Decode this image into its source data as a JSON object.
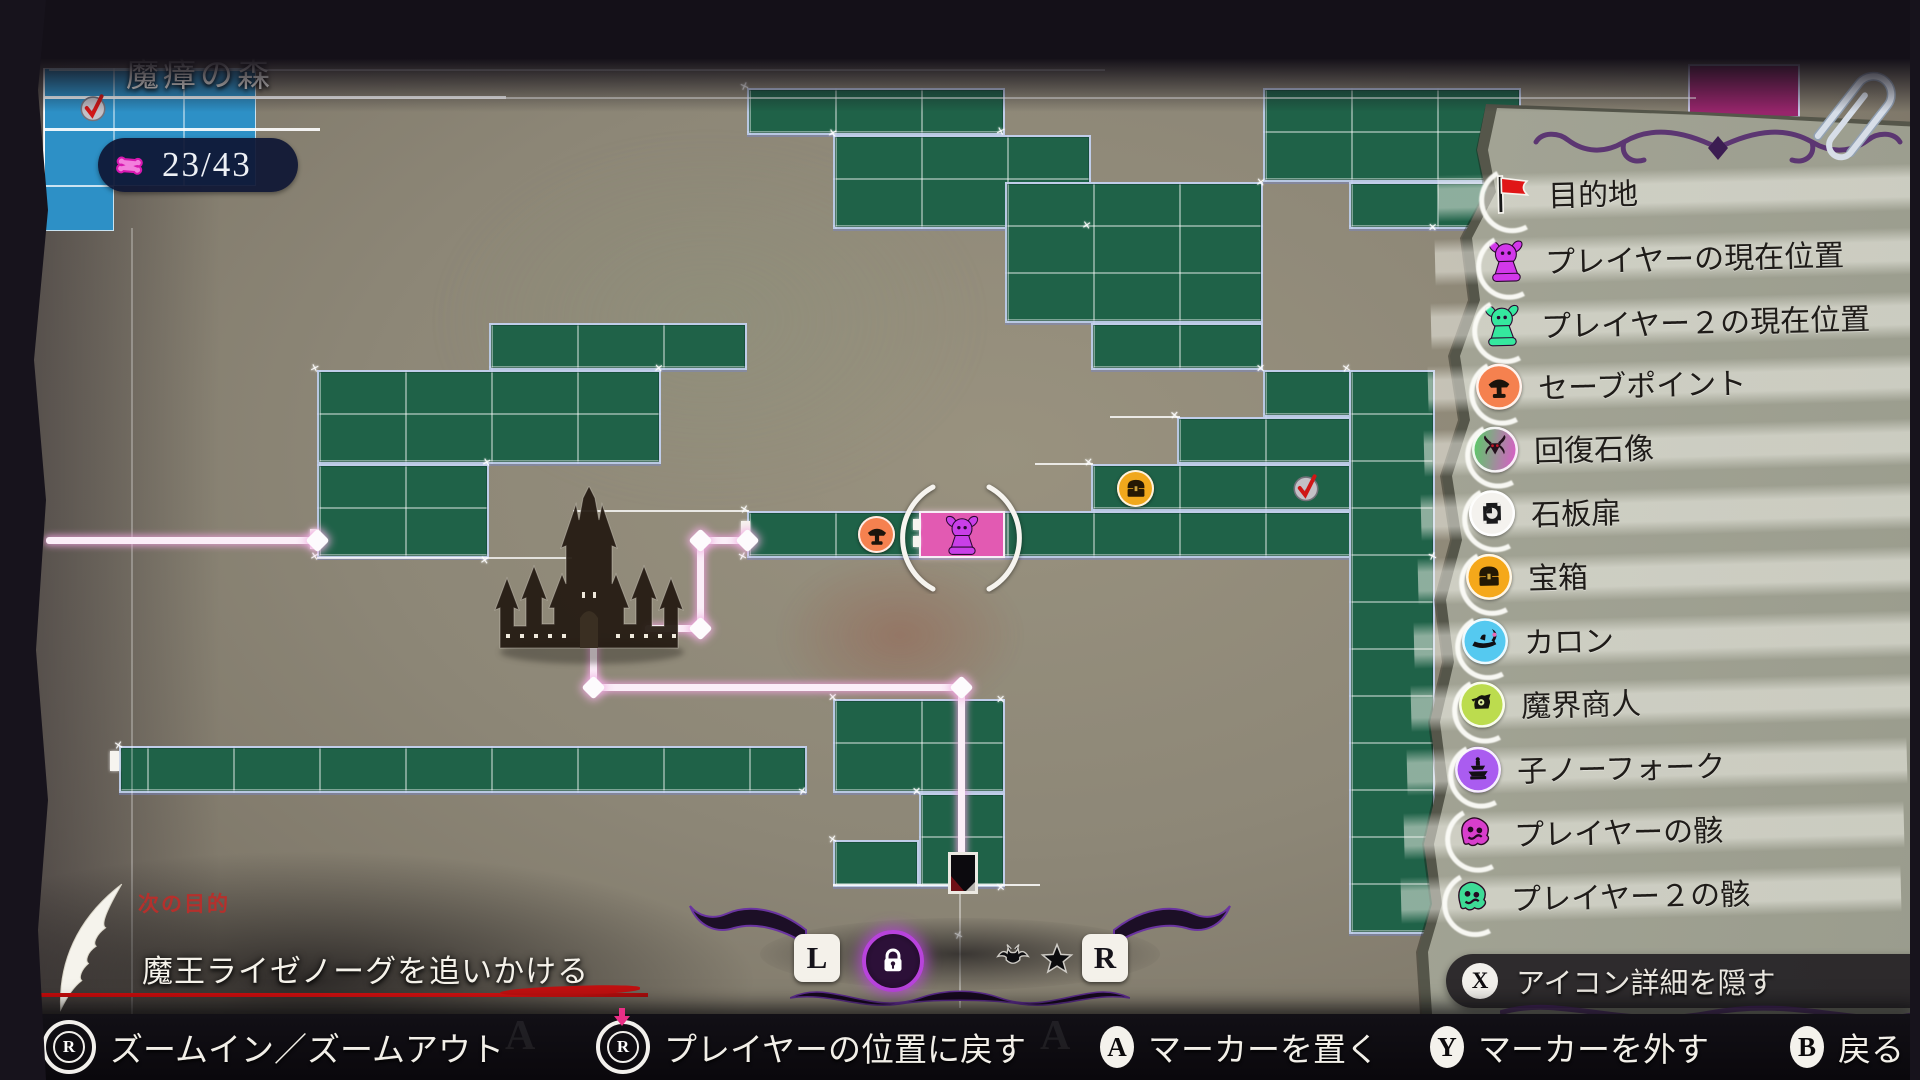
{
  "map": {
    "title": "魔瘴の森",
    "counter": "23/43",
    "grid": {
      "ox": 59,
      "oy": 88,
      "cw": 86,
      "ch": 47
    },
    "green_cells": [
      [
        8,
        0,
        3,
        1
      ],
      [
        9,
        1,
        3,
        2
      ],
      [
        11,
        2,
        3,
        3
      ],
      [
        12,
        5,
        2,
        1
      ],
      [
        14,
        0,
        3,
        2
      ],
      [
        15,
        2,
        2,
        1
      ],
      [
        14,
        6,
        2,
        1
      ],
      [
        13,
        7,
        3,
        1
      ],
      [
        12,
        8,
        4,
        1
      ],
      [
        8,
        9,
        8,
        1
      ],
      [
        15,
        6,
        1,
        12
      ],
      [
        5,
        5,
        3,
        1
      ],
      [
        3,
        6,
        4,
        2
      ],
      [
        3,
        8,
        2,
        2
      ],
      [
        9,
        13,
        2,
        2
      ],
      [
        10,
        15,
        1,
        2
      ],
      [
        9,
        16,
        1,
        1
      ]
    ],
    "free_green": [
      [
        119,
        746,
        688,
        47
      ]
    ],
    "blue_cells": [
      [
        44,
        68,
        212,
        118
      ],
      [
        44,
        186,
        70,
        45
      ]
    ],
    "magenta_cells": [
      [
        1688,
        64,
        112,
        54
      ]
    ],
    "pink_room": {
      "c": 10,
      "r": 9
    },
    "lines": [
      {
        "o": "h",
        "x": 49,
        "y": 70,
        "l": 1056,
        "t": 1.5,
        "a": 0.65
      },
      {
        "o": "h",
        "x": 44,
        "y": 97,
        "l": 462,
        "t": 3,
        "a": 0.95
      },
      {
        "o": "h",
        "x": 506,
        "y": 98,
        "l": 1190,
        "t": 2,
        "a": 0.55
      },
      {
        "o": "h",
        "x": 44,
        "y": 129,
        "l": 276,
        "t": 3,
        "a": 0.9
      },
      {
        "o": "v",
        "x": 132,
        "y": 228,
        "l": 830,
        "t": 1.5,
        "a": 0.28
      },
      {
        "o": "v",
        "x": 44,
        "y": 68,
        "l": 162,
        "t": 2,
        "a": 0.85
      },
      {
        "o": "v",
        "x": 114,
        "y": 68,
        "l": 118,
        "t": 1.5,
        "a": 0.45
      },
      {
        "o": "v",
        "x": 184,
        "y": 68,
        "l": 118,
        "t": 1.5,
        "a": 0.45
      },
      {
        "o": "h",
        "x": 317,
        "y": 558,
        "l": 255,
        "t": 2,
        "a": 0.75
      },
      {
        "o": "h",
        "x": 573,
        "y": 511,
        "l": 176,
        "t": 2,
        "a": 0.8
      },
      {
        "o": "h",
        "x": 833,
        "y": 885,
        "l": 207,
        "t": 2,
        "a": 0.85
      },
      {
        "o": "v",
        "x": 960,
        "y": 893,
        "l": 115,
        "t": 1.5,
        "a": 0.4
      },
      {
        "o": "h",
        "x": 1110,
        "y": 417,
        "l": 70,
        "t": 2,
        "a": 0.8
      },
      {
        "o": "h",
        "x": 1035,
        "y": 464,
        "l": 58,
        "t": 2,
        "a": 0.8
      }
    ],
    "door_ticks": [
      [
        741,
        521,
        9,
        20
      ],
      [
        913,
        519,
        7,
        11
      ],
      [
        913,
        536,
        7,
        11
      ],
      [
        310,
        529,
        9,
        20
      ],
      [
        110,
        751,
        9,
        20
      ]
    ],
    "sparkles": [
      [
        745,
        86
      ],
      [
        1001,
        131
      ],
      [
        833,
        133
      ],
      [
        1087,
        225
      ],
      [
        1261,
        182
      ],
      [
        1517,
        182
      ],
      [
        1433,
        227
      ],
      [
        1261,
        368
      ],
      [
        1175,
        415
      ],
      [
        1089,
        462
      ],
      [
        1347,
        368
      ],
      [
        745,
        509
      ],
      [
        743,
        556
      ],
      [
        1433,
        556
      ],
      [
        315,
        368
      ],
      [
        487,
        462
      ],
      [
        315,
        556
      ],
      [
        485,
        560
      ],
      [
        659,
        368
      ],
      [
        833,
        697
      ],
      [
        1001,
        699
      ],
      [
        917,
        791
      ],
      [
        1001,
        887
      ],
      [
        833,
        839
      ],
      [
        119,
        745
      ],
      [
        803,
        791
      ],
      [
        959,
        935
      ],
      [
        1433,
        935
      ]
    ],
    "route": {
      "segments": [
        {
          "o": "h",
          "x": 46,
          "y": 540,
          "l": 271
        },
        {
          "o": "h",
          "x": 700,
          "y": 540,
          "l": 47
        },
        {
          "o": "v",
          "x": 700,
          "y": 540,
          "l": 88
        },
        {
          "o": "h",
          "x": 645,
          "y": 628,
          "l": 57
        },
        {
          "o": "v",
          "x": 593,
          "y": 640,
          "l": 47
        },
        {
          "o": "h",
          "x": 593,
          "y": 687,
          "l": 368
        },
        {
          "o": "v",
          "x": 961,
          "y": 687,
          "l": 169
        }
      ],
      "nodes": [
        [
          317,
          540
        ],
        [
          700,
          540
        ],
        [
          747,
          540
        ],
        [
          700,
          628
        ],
        [
          593,
          687
        ],
        [
          961,
          687
        ]
      ]
    },
    "icons": [
      {
        "name": "check",
        "x": 75,
        "y": 90
      },
      {
        "name": "check",
        "x": 1288,
        "y": 470
      },
      {
        "name": "chest",
        "x": 1117,
        "y": 470
      },
      {
        "name": "save",
        "x": 858,
        "y": 516
      },
      {
        "name": "player",
        "x": 941,
        "y": 514
      },
      {
        "name": "gate-marker",
        "x": 948,
        "y": 852
      }
    ]
  },
  "legend": {
    "items": [
      {
        "icon": "flag",
        "label": "目的地",
        "bg": "none",
        "color": "#e01616"
      },
      {
        "icon": "pawn",
        "label": "プレイヤーの現在位置",
        "bg": "none",
        "color": "#d238ea"
      },
      {
        "icon": "pawn",
        "label": "プレイヤー２の現在位置",
        "bg": "none",
        "color": "#35e89e"
      },
      {
        "icon": "save",
        "label": "セーブポイント",
        "bg": "#f5814f",
        "color": "#1c140c"
      },
      {
        "icon": "statue",
        "label": "回復石像",
        "bg": "grad",
        "color": "#23101c"
      },
      {
        "icon": "slab",
        "label": "石板扉",
        "bg": "#f4f2ee",
        "color": "#1a1a1c"
      },
      {
        "icon": "chest",
        "label": "宝箱",
        "bg": "#f5a81a",
        "color": "#241804"
      },
      {
        "icon": "boat",
        "label": "カロン",
        "bg": "#55c9f0",
        "color": "#101014"
      },
      {
        "icon": "merchant",
        "label": "魔界商人",
        "bg": "#bcdc4e",
        "color": "#15150f"
      },
      {
        "icon": "fountain",
        "label": "子ノーフォーク",
        "bg": "#aa5cf0",
        "color": "#140f16"
      },
      {
        "icon": "remains",
        "label": "プレイヤーの骸",
        "bg": "none",
        "color": "#d83ecc"
      },
      {
        "icon": "remains",
        "label": "プレイヤー２の骸",
        "bg": "none",
        "color": "#3eda96"
      }
    ],
    "hide_hint": {
      "button": "X",
      "label": "アイコン詳細を隠す"
    }
  },
  "objective": {
    "heading": "次の目的",
    "text": "魔王ライゼノーグを追いかける"
  },
  "toolbar": {
    "l": "L",
    "r": "R",
    "filters": [
      "lock",
      "bat",
      "star",
      "trap"
    ],
    "active": "lock",
    "accent": "#b843dc"
  },
  "bottom_bar": {
    "items": [
      {
        "button": "rstick",
        "label": "ズームイン／ズームアウト",
        "x": 42
      },
      {
        "button": "rstick-press",
        "label": "プレイヤーの位置に戻す",
        "x": 596
      },
      {
        "button": "A",
        "label": "マーカーを置く",
        "x": 1100
      },
      {
        "button": "Y",
        "label": "マーカーを外す",
        "x": 1430
      },
      {
        "button": "B",
        "label": "戻る",
        "x": 1790
      }
    ]
  }
}
